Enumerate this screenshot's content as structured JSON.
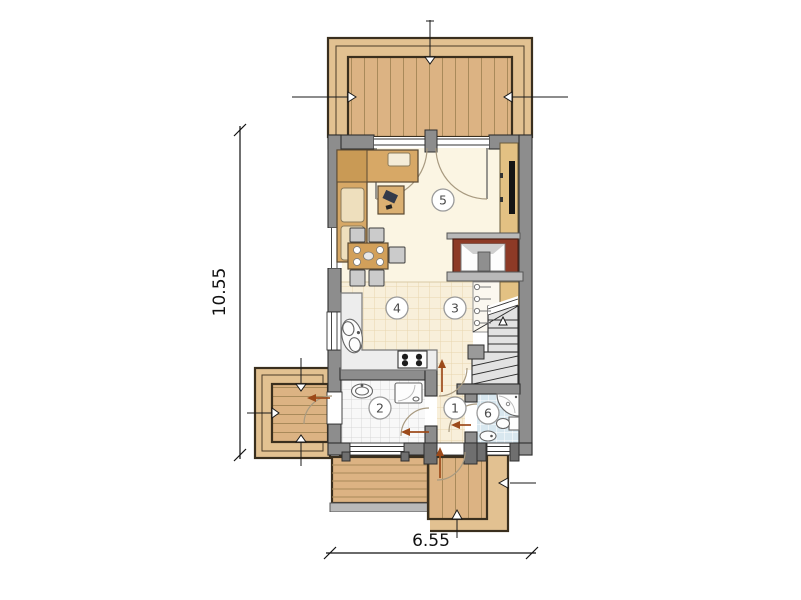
{
  "plan": {
    "dimensions": {
      "vertical_label": "10.55",
      "horizontal_label": "6.55"
    },
    "rooms": [
      {
        "label": "1"
      },
      {
        "label": "2"
      },
      {
        "label": "3"
      },
      {
        "label": "4"
      },
      {
        "label": "5"
      },
      {
        "label": "6"
      }
    ],
    "colors": {
      "wall": "#8d8d8d",
      "wall_outline": "#2f2f2f",
      "deck_wood": "#dcb383",
      "deck_band": "#e2c191",
      "plank_line": "#a98a5a",
      "floor_cream": "#fbf5e3",
      "floor_tile_beige": "#f8efda",
      "floor_tile_white": "#f8f8f8",
      "floor_tile_blue": "#d8e7ef",
      "furniture_tan": "#d7a866",
      "cushion_light": "#eedfbd",
      "chair_gray": "#cbcbcb",
      "counter_gray": "#ededed",
      "stair_gray": "#e2e2e2",
      "fireplace_red": "#8d3a26",
      "tv_black": "#151515",
      "cabinet_tan": "#e3c183",
      "arrow_brown": "#9c4a1a",
      "dimension_black": "#111111"
    }
  }
}
